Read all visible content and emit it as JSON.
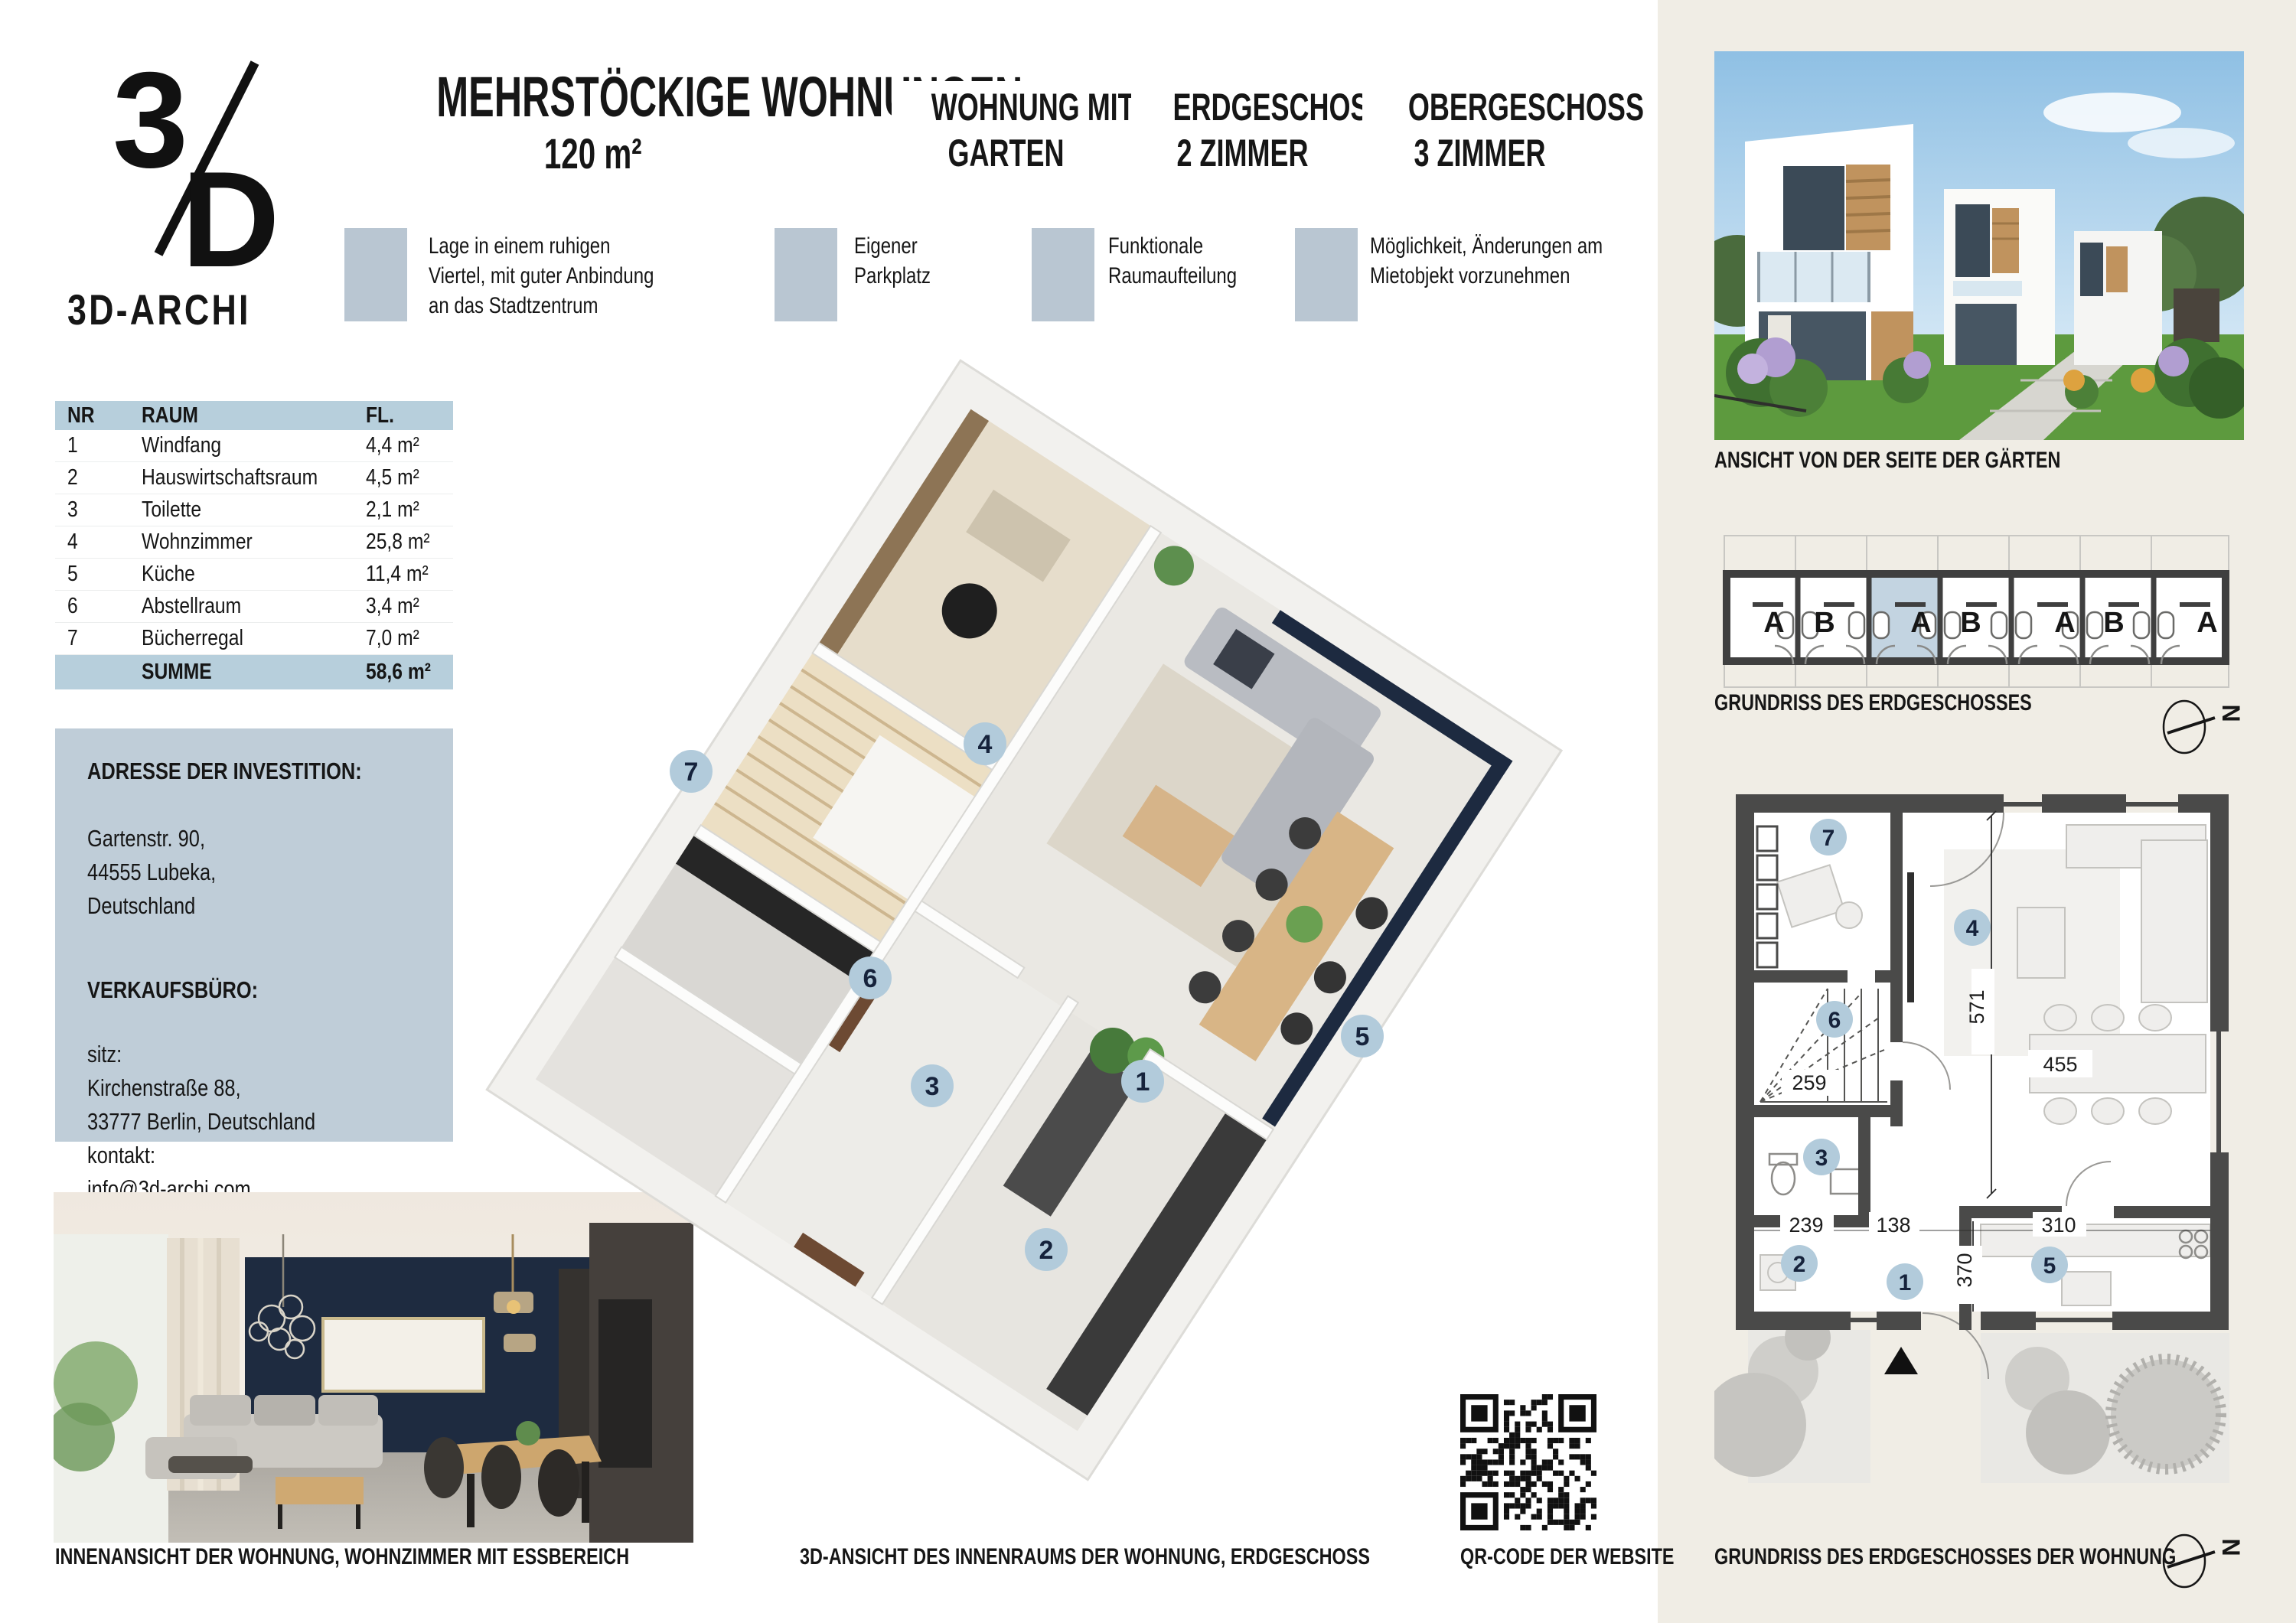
{
  "colors": {
    "cream_panel": "#f0ede5",
    "feature_square_blue": "#b9c6d2",
    "table_blue": "#b7cfdc",
    "address_blue": "#bfcdd8",
    "badge_blue": "#b2cbdb",
    "navy_wall": "#1c2940",
    "plan_wall_gray": "#4a4a49"
  },
  "logo": {
    "mark_top": "3",
    "mark_bottom": "D",
    "name": "3D-ARCHI"
  },
  "header": {
    "title": "MEHRSTÖCKIGE WOHNUNGEN",
    "area": "120 m²"
  },
  "columns": [
    {
      "line1": "WOHNUNG MIT",
      "line2": "GARTEN"
    },
    {
      "line1": "ERDGESCHOSS",
      "line2": "2 ZIMMER"
    },
    {
      "line1": "OBERGESCHOSS",
      "line2": "3 ZIMMER"
    }
  ],
  "features": [
    "Lage in einem ruhigen Viertel, mit guter Anbindung an das Stadtzentrum",
    "Eigener Parkplatz",
    "Funktionale Raumaufteilung",
    "Möglichkeit, Änderungen am Mietobjekt vorzunehmen"
  ],
  "room_table": {
    "headers": [
      "NR",
      "RAUM",
      "FL."
    ],
    "rows": [
      [
        "1",
        "Windfang",
        "4,4 m²"
      ],
      [
        "2",
        "Hauswirtschaftsraum",
        "4,5 m²"
      ],
      [
        "3",
        "Toilette",
        "2,1 m²"
      ],
      [
        "4",
        "Wohnzimmer",
        "25,8 m²"
      ],
      [
        "5",
        "Küche",
        "11,4 m²"
      ],
      [
        "6",
        "Abstellraum",
        "3,4 m²"
      ],
      [
        "7",
        "Bücherregal",
        "7,0 m²"
      ]
    ],
    "sum_label": "SUMME",
    "sum_value": "58,6 m²"
  },
  "address": {
    "title1": "ADRESSE DER INVESTITION:",
    "lines1": [
      "Gartenstr. 90,",
      "44555 Lubeka,",
      "Deutschland"
    ],
    "title2": "VERKAUFSBÜRO:",
    "lines2": [
      "sitz:",
      "Kirchenstraße 88,",
      "33777 Berlin, Deutschland",
      "kontakt:",
      "info@3d-archi.com",
      "+49 886 610 700"
    ]
  },
  "captions": {
    "interior": "INNENANSICHT DER WOHNUNG, WOHNZIMMER MIT ESSBEREICH",
    "plan3d": "3D-ANSICHT DES INNENRAUMS DER WOHNUNG, ERDGESCHOSS",
    "qr": "QR-CODE DER WEBSITE",
    "exterior": "ANSICHT VON DER SEITE DER GÄRTEN",
    "schematic": "GRUNDRISS DES ERDGESCHOSSES",
    "plan2d": "GRUNDRISS DES ERDGESCHOSSES DER WOHNUNG"
  },
  "schematic": {
    "units": [
      "A",
      "B",
      "A",
      "B",
      "A",
      "B",
      "A"
    ],
    "highlight_index": 2
  },
  "badges3d": [
    {
      "n": "7"
    },
    {
      "n": "4"
    },
    {
      "n": "6"
    },
    {
      "n": "3"
    },
    {
      "n": "1"
    },
    {
      "n": "5"
    },
    {
      "n": "2"
    }
  ],
  "plan2d": {
    "badges": [
      {
        "n": "7"
      },
      {
        "n": "4"
      },
      {
        "n": "6"
      },
      {
        "n": "3"
      },
      {
        "n": "2"
      },
      {
        "n": "1"
      },
      {
        "n": "5"
      }
    ],
    "dims": {
      "v_living": "571",
      "h_dining": "455",
      "h_stairs": "259",
      "b_left": "239",
      "b_mid": "138",
      "b_right": "310",
      "v_kitchen": "370"
    }
  },
  "compass": {
    "letter": "N"
  }
}
